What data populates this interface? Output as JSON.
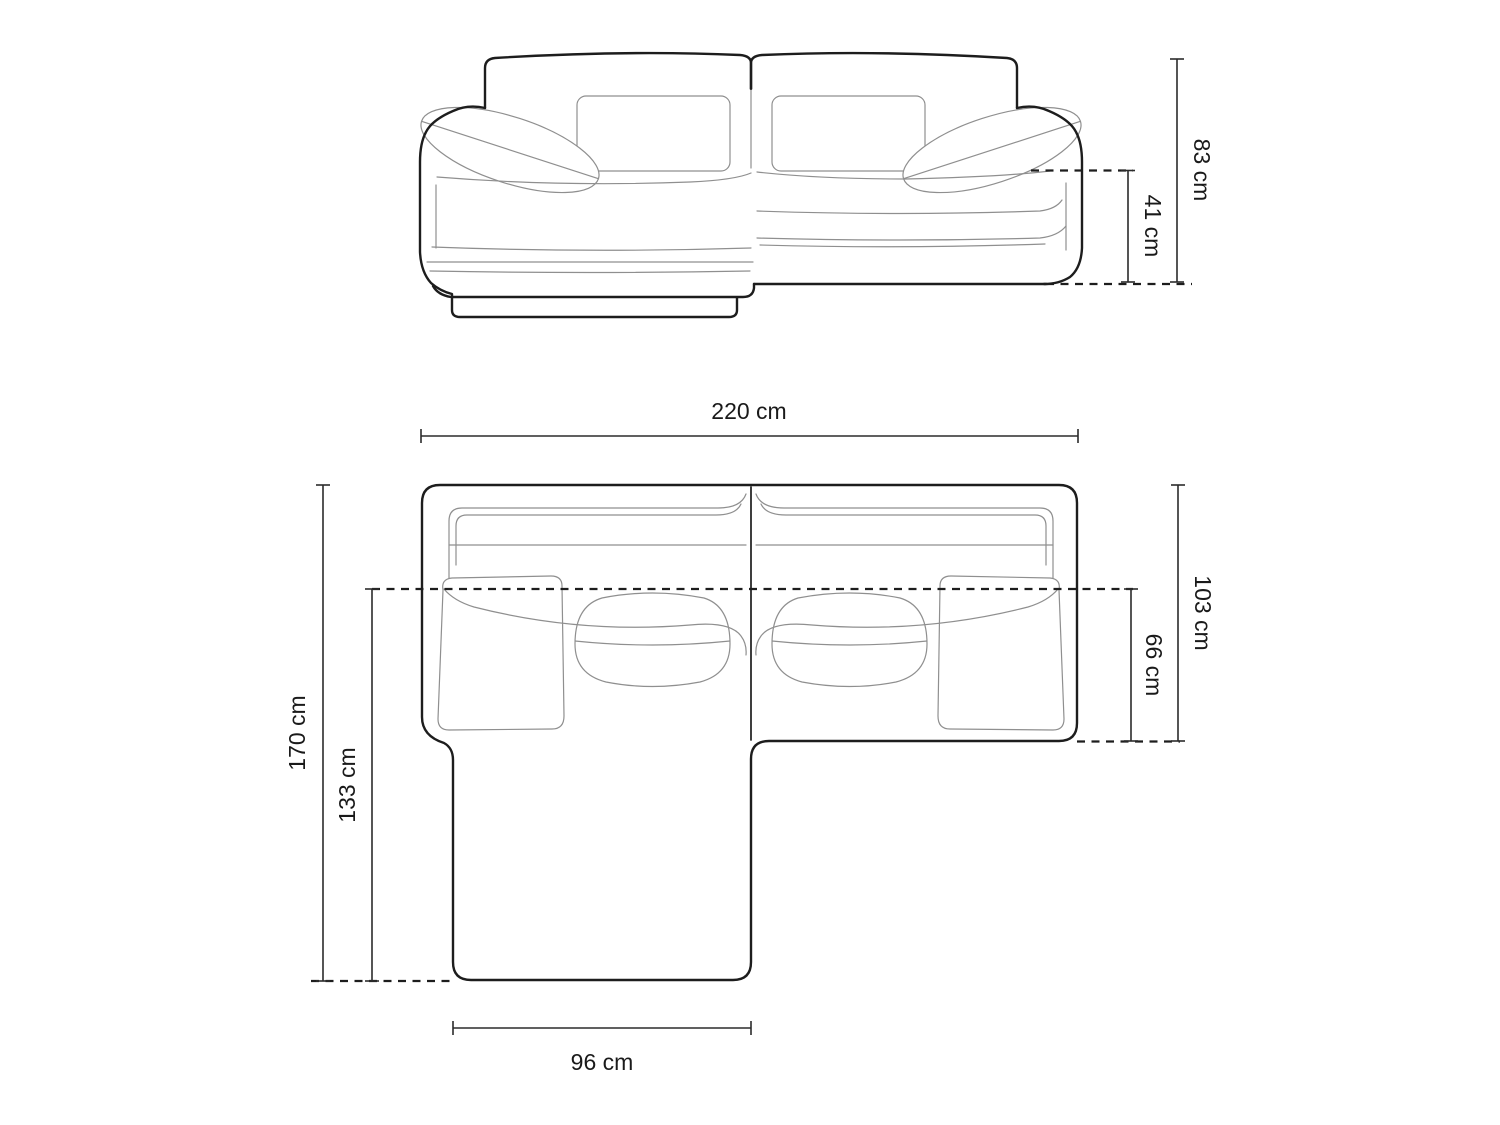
{
  "diagram": {
    "kind": "sofa-dimension-drawing",
    "labels": {
      "total_height": "83 cm",
      "seat_height": "41 cm",
      "total_width": "220 cm",
      "total_depth": "103 cm",
      "seat_depth": "66 cm",
      "chaise_total_length": "170 cm",
      "chaise_clear_length": "133 cm",
      "chaise_width": "96 cm"
    },
    "colors": {
      "background": "#ffffff",
      "outline": "#1d1d1d",
      "seam": "#8f8f8f",
      "dimension_line": "#2b2b2b",
      "dashed_line": "#1d1d1d",
      "text": "#1a1a1a"
    }
  }
}
